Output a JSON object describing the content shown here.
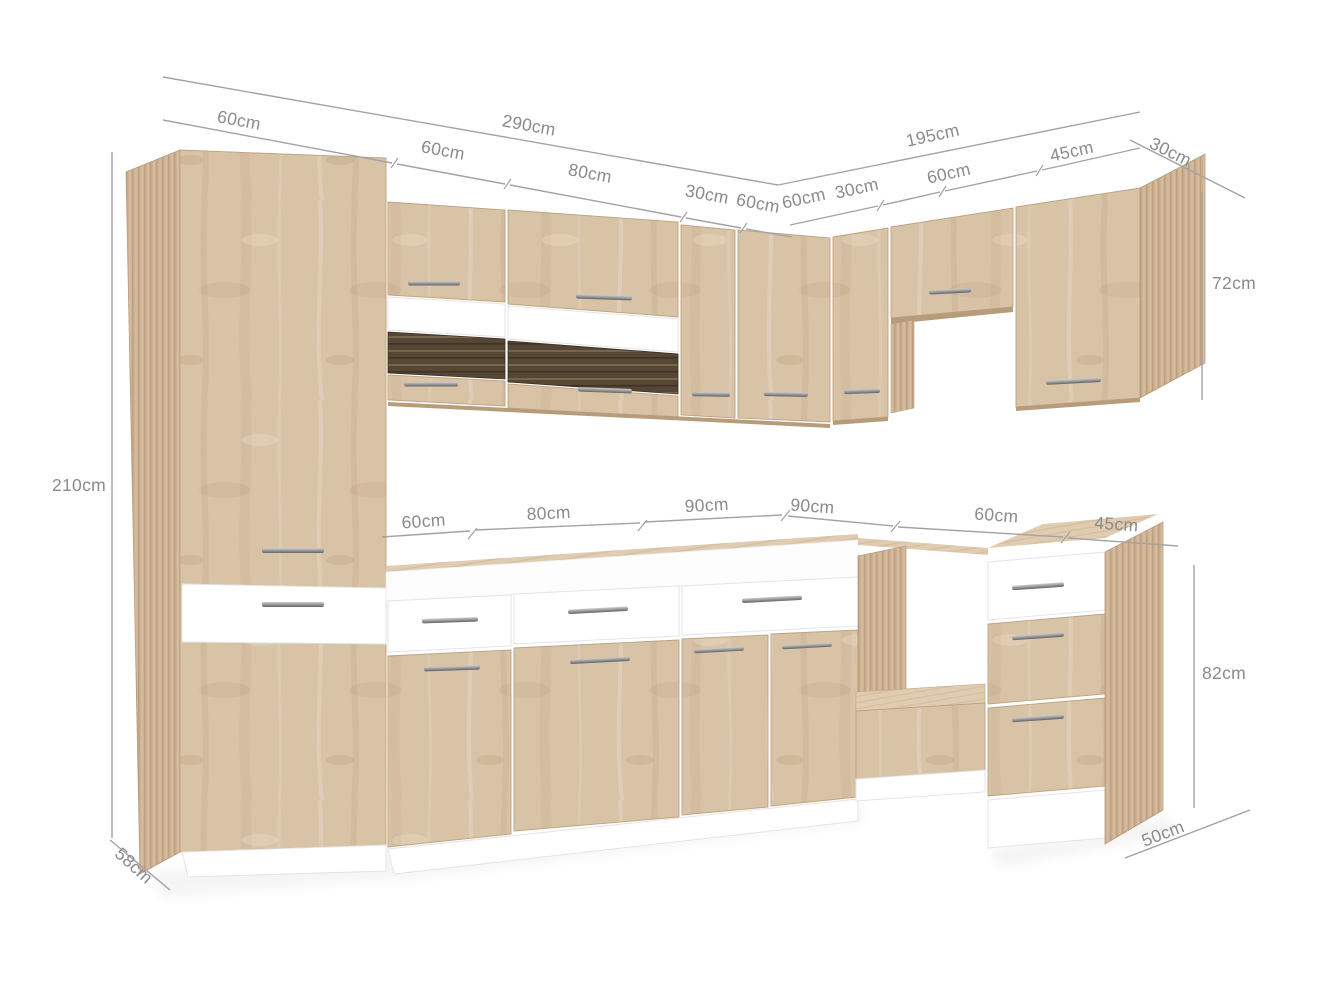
{
  "diagram": {
    "subject": "corner-kitchen-cabinet-set",
    "units": "cm"
  },
  "dims": {
    "left_total": "290cm",
    "tall_width": "60cm",
    "wall_60": "60cm",
    "wall_80": "80cm",
    "wall_30": "30cm",
    "wall_corner_60": "60cm",
    "right_total": "195cm",
    "rwall_60": "60cm",
    "rwall_30": "30cm",
    "rwall_60b": "60cm",
    "rwall_45": "45cm",
    "wall_depth": "30cm",
    "wall_height": "72cm",
    "tall_height": "210cm",
    "tall_depth": "58cm",
    "base_60": "60cm",
    "base_80": "80cm",
    "base_90": "90cm",
    "rbase_90": "90cm",
    "rbase_60": "60cm",
    "rbase_45": "45cm",
    "base_height": "82cm",
    "base_depth": "50cm"
  },
  "colors": {
    "wood_front": "#d8c3a7",
    "wood_side": "#cdb293",
    "wood_top": "#e0ccb1",
    "wood_underside": "#b79c7c",
    "glass": "#564634",
    "front_white": "#ffffff",
    "handle": "#9a9a9a",
    "dimension_line": "#a3a3a3",
    "dimension_text": "#8b8b8b",
    "background": "#ffffff"
  }
}
